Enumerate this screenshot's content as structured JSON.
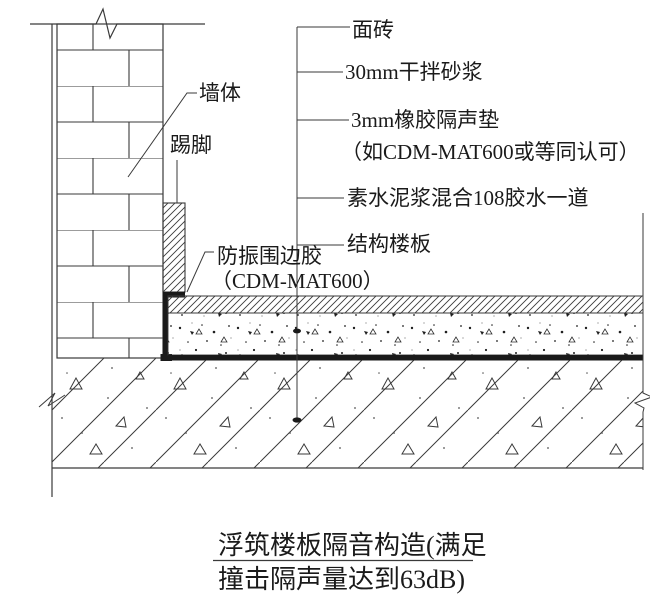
{
  "drawing": {
    "labels_right": [
      "面砖",
      "30mm干拌砂浆",
      "3mm橡胶隔声垫",
      "（如CDM-MAT600或等同认可）",
      "素水泥浆混合108胶水一道",
      "结构楼板"
    ],
    "labels_left": {
      "wall": "墙体",
      "skirting": "踢脚",
      "perimeter_glue_line1": "防振围边胶",
      "perimeter_glue_line2": "（CDM-MAT600）"
    },
    "title": {
      "line1": "浮筑楼板隔音构造(满足",
      "line2": "撞击隔声量达到63dB)"
    },
    "colors": {
      "line": "#3a3a3a",
      "text": "#1a1a1a",
      "background": "#ffffff",
      "dark_fill": "#1a1a1a"
    }
  }
}
